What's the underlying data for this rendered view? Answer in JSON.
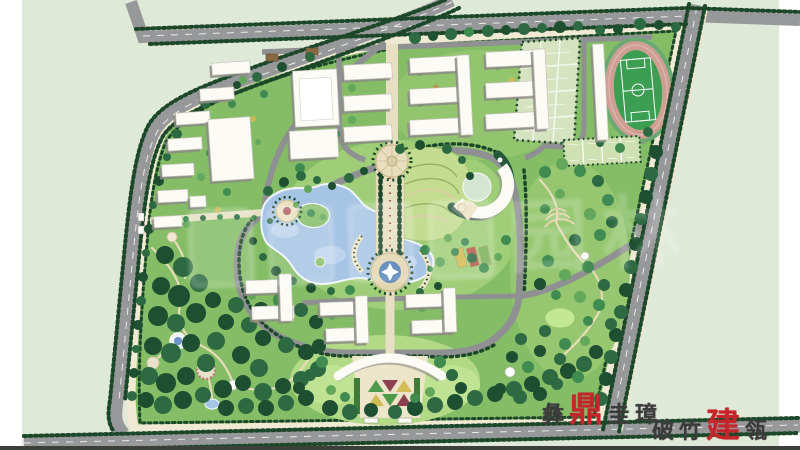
{
  "canvas": {
    "width": 800,
    "height": 450
  },
  "watermarks": {
    "center_glyphs": [
      "园",
      "林"
    ],
    "seal_line1": [
      "彝",
      "鼎",
      "圭",
      "璋"
    ],
    "seal_line2": [
      "破",
      "竹",
      "建",
      "瓴"
    ],
    "seal_red_chars": [
      "鼎",
      "建"
    ]
  },
  "palette": {
    "outer_bg": "#dfe9d8",
    "campus_green": "#85bd66",
    "lawn_light": "#a9d37e",
    "lawn_bright": "#bfe392",
    "sidewalk_cream": "#f0e9d4",
    "road_gray": "#97989a",
    "inner_road_gray": "#8f9092",
    "hedge_dark": "#1c4729",
    "lake_blue": "#a6c4e4",
    "lake_highlight": "#c6daf1",
    "track_pink": "#cf9f94",
    "field_green": "#3b9e52",
    "court_fill": "#d6e3c0",
    "building_white": "#fcfbf6",
    "building_shadow": "#8b8b85",
    "axis_cream": "#e7dfc2",
    "seal_red": "#c5262b",
    "seal_black": "#3b3b3b",
    "parterre_green": "#4e9a4a",
    "parterre_maroon": "#8d4050",
    "parterre_yellow": "#d2bc55"
  },
  "tree_colors": [
    "#1d4f30",
    "#2d6a42",
    "#3f8b50",
    "#63a75a",
    "#8cc06a",
    "#c9ba55",
    "#bf8c4a"
  ],
  "buildings": [
    [
      212,
      62,
      38,
      12,
      -4
    ],
    [
      200,
      88,
      34,
      12,
      -4
    ],
    [
      176,
      112,
      34,
      12,
      -4
    ],
    [
      168,
      138,
      34,
      12,
      -4
    ],
    [
      162,
      164,
      32,
      12,
      -3
    ],
    [
      158,
      190,
      30,
      12,
      -3
    ],
    [
      190,
      196,
      16,
      11,
      -3
    ],
    [
      154,
      216,
      28,
      11,
      -3
    ],
    [
      210,
      118,
      42,
      62,
      -4
    ],
    [
      294,
      70,
      44,
      56,
      -3
    ],
    [
      290,
      130,
      48,
      28,
      -3
    ],
    [
      344,
      64,
      48,
      15,
      -3
    ],
    [
      344,
      95,
      48,
      15,
      -3
    ],
    [
      344,
      126,
      48,
      15,
      -3
    ],
    [
      410,
      57,
      50,
      15,
      -3
    ],
    [
      410,
      88,
      50,
      15,
      -3
    ],
    [
      410,
      119,
      50,
      15,
      -3
    ],
    [
      459,
      55,
      12,
      80,
      -3
    ],
    [
      486,
      51,
      50,
      15,
      -3
    ],
    [
      486,
      82,
      50,
      15,
      -3
    ],
    [
      486,
      113,
      50,
      15,
      -3
    ],
    [
      535,
      49,
      12,
      80,
      -3
    ],
    [
      246,
      280,
      40,
      13,
      -2
    ],
    [
      252,
      306,
      42,
      13,
      -2
    ],
    [
      280,
      274,
      12,
      47,
      -2
    ],
    [
      320,
      302,
      40,
      13,
      -2
    ],
    [
      326,
      328,
      42,
      13,
      -2
    ],
    [
      356,
      296,
      12,
      47,
      -2
    ],
    [
      406,
      294,
      40,
      13,
      -2
    ],
    [
      412,
      320,
      42,
      13,
      -2
    ],
    [
      444,
      288,
      12,
      44,
      -2
    ],
    [
      595,
      44,
      11,
      96,
      -3
    ]
  ],
  "trees": [
    [
      415,
      38,
      6,
      1
    ],
    [
      433,
      36,
      5,
      0
    ],
    [
      451,
      34,
      6,
      1
    ],
    [
      469,
      32,
      5,
      2
    ],
    [
      488,
      31,
      6,
      1
    ],
    [
      506,
      30,
      5,
      0
    ],
    [
      524,
      29,
      6,
      1
    ],
    [
      542,
      28,
      5,
      1
    ],
    [
      560,
      27,
      6,
      0
    ],
    [
      578,
      26,
      5,
      1
    ],
    [
      640,
      24,
      6,
      1
    ],
    [
      659,
      25,
      5,
      0
    ],
    [
      676,
      27,
      5,
      1
    ],
    [
      310,
      57,
      5,
      1
    ],
    [
      282,
      67,
      5,
      0
    ],
    [
      257,
      77,
      5,
      1
    ],
    [
      237,
      85,
      4,
      0
    ],
    [
      222,
      93,
      4,
      1
    ],
    [
      205,
      103,
      5,
      1
    ],
    [
      190,
      117,
      4,
      0
    ],
    [
      177,
      134,
      5,
      1
    ],
    [
      167,
      157,
      4,
      1
    ],
    [
      159,
      181,
      5,
      0
    ],
    [
      153,
      205,
      4,
      1
    ],
    [
      149,
      229,
      5,
      0
    ],
    [
      146,
      253,
      4,
      1
    ],
    [
      143,
      277,
      5,
      0
    ],
    [
      141,
      301,
      5,
      1
    ],
    [
      138,
      325,
      5,
      0
    ],
    [
      136,
      349,
      4,
      1
    ],
    [
      134,
      373,
      5,
      0
    ],
    [
      132,
      396,
      5,
      1
    ],
    [
      243,
      80,
      4,
      3
    ],
    [
      232,
      104,
      4,
      2
    ],
    [
      220,
      129,
      4,
      3
    ],
    [
      210,
      153,
      4,
      2
    ],
    [
      201,
      177,
      4,
      3
    ],
    [
      193,
      201,
      4,
      2
    ],
    [
      187,
      224,
      4,
      3
    ],
    [
      264,
      94,
      4,
      2
    ],
    [
      253,
      119,
      3,
      5
    ],
    [
      243,
      143,
      4,
      2
    ],
    [
      234,
      168,
      3,
      6
    ],
    [
      227,
      192,
      4,
      2
    ],
    [
      258,
      142,
      3,
      3
    ],
    [
      218,
      210,
      3,
      5
    ],
    [
      300,
      168,
      5,
      2
    ],
    [
      318,
      150,
      5,
      3
    ],
    [
      336,
      134,
      4,
      2
    ],
    [
      308,
      189,
      4,
      3
    ],
    [
      283,
      184,
      4,
      2
    ],
    [
      296,
      205,
      3,
      3
    ],
    [
      270,
      221,
      3,
      1
    ],
    [
      254,
      218,
      3,
      2
    ],
    [
      237,
      217,
      3,
      1
    ],
    [
      220,
      217,
      3,
      2
    ],
    [
      203,
      218,
      3,
      1
    ],
    [
      186,
      219,
      3,
      2
    ],
    [
      170,
      220,
      3,
      1
    ],
    [
      268,
      191,
      5,
      1
    ],
    [
      284,
      182,
      5,
      0
    ],
    [
      301,
      176,
      5,
      1
    ],
    [
      317,
      180,
      4,
      1
    ],
    [
      332,
      186,
      4,
      0
    ],
    [
      349,
      178,
      5,
      1
    ],
    [
      364,
      171,
      4,
      0
    ],
    [
      311,
      213,
      4,
      2
    ],
    [
      323,
      217,
      3,
      3
    ],
    [
      400,
      149,
      5,
      1
    ],
    [
      420,
      145,
      5,
      0
    ],
    [
      447,
      149,
      5,
      1
    ],
    [
      462,
      160,
      4,
      1
    ],
    [
      470,
      176,
      4,
      0
    ],
    [
      350,
      290,
      5,
      2
    ],
    [
      331,
      291,
      4,
      1
    ],
    [
      311,
      288,
      5,
      0
    ],
    [
      293,
      281,
      4,
      1
    ],
    [
      276,
      271,
      5,
      0
    ],
    [
      263,
      257,
      4,
      1
    ],
    [
      253,
      241,
      4,
      0
    ],
    [
      420,
      292,
      4,
      1
    ],
    [
      438,
      286,
      4,
      0
    ],
    [
      430,
      269,
      3,
      2
    ],
    [
      165,
      255,
      9,
      0
    ],
    [
      183,
      267,
      10,
      1
    ],
    [
      161,
      286,
      9,
      0
    ],
    [
      179,
      296,
      11,
      0
    ],
    [
      199,
      283,
      9,
      1
    ],
    [
      158,
      316,
      10,
      0
    ],
    [
      176,
      323,
      9,
      1
    ],
    [
      196,
      313,
      10,
      0
    ],
    [
      153,
      346,
      9,
      0
    ],
    [
      171,
      353,
      10,
      1
    ],
    [
      191,
      343,
      9,
      0
    ],
    [
      149,
      376,
      9,
      1
    ],
    [
      166,
      383,
      10,
      0
    ],
    [
      186,
      376,
      9,
      0
    ],
    [
      206,
      363,
      9,
      1
    ],
    [
      146,
      400,
      8,
      0
    ],
    [
      163,
      405,
      9,
      1
    ],
    [
      183,
      400,
      9,
      0
    ],
    [
      203,
      395,
      8,
      1
    ],
    [
      223,
      389,
      9,
      0
    ],
    [
      216,
      341,
      9,
      1
    ],
    [
      226,
      322,
      8,
      0
    ],
    [
      236,
      305,
      8,
      1
    ],
    [
      213,
      300,
      8,
      0
    ],
    [
      241,
      355,
      9,
      0
    ],
    [
      259,
      368,
      9,
      1
    ],
    [
      243,
      383,
      8,
      0
    ],
    [
      263,
      392,
      9,
      1
    ],
    [
      283,
      386,
      8,
      0
    ],
    [
      301,
      379,
      8,
      1
    ],
    [
      226,
      408,
      8,
      0
    ],
    [
      246,
      406,
      8,
      1
    ],
    [
      266,
      408,
      8,
      0
    ],
    [
      286,
      403,
      8,
      1
    ],
    [
      306,
      398,
      8,
      0
    ],
    [
      318,
      369,
      8,
      1
    ],
    [
      306,
      352,
      8,
      0
    ],
    [
      286,
      345,
      8,
      1
    ],
    [
      263,
      338,
      8,
      0
    ],
    [
      249,
      325,
      8,
      1
    ],
    [
      261,
      310,
      8,
      0
    ],
    [
      281,
      300,
      8,
      2
    ],
    [
      301,
      310,
      7,
      1
    ],
    [
      316,
      322,
      7,
      0
    ],
    [
      331,
      335,
      7,
      1
    ],
    [
      319,
      346,
      7,
      0
    ],
    [
      330,
      408,
      8,
      0
    ],
    [
      350,
      412,
      8,
      1
    ],
    [
      371,
      410,
      7,
      0
    ],
    [
      395,
      412,
      7,
      1
    ],
    [
      415,
      408,
      8,
      0
    ],
    [
      435,
      405,
      8,
      1
    ],
    [
      455,
      402,
      8,
      0
    ],
    [
      475,
      398,
      8,
      1
    ],
    [
      495,
      394,
      8,
      0
    ],
    [
      514,
      389,
      8,
      1
    ],
    [
      532,
      384,
      8,
      0
    ],
    [
      550,
      377,
      8,
      1
    ],
    [
      568,
      371,
      8,
      0
    ],
    [
      584,
      364,
      8,
      1
    ],
    [
      596,
      352,
      7,
      0
    ],
    [
      656,
      152,
      7,
      0
    ],
    [
      651,
      174,
      7,
      1
    ],
    [
      646,
      197,
      7,
      0
    ],
    [
      641,
      219,
      6,
      1
    ],
    [
      636,
      244,
      7,
      0
    ],
    [
      631,
      267,
      7,
      1
    ],
    [
      626,
      290,
      7,
      0
    ],
    [
      621,
      312,
      7,
      1
    ],
    [
      616,
      335,
      7,
      0
    ],
    [
      611,
      357,
      7,
      1
    ],
    [
      606,
      379,
      7,
      0
    ],
    [
      601,
      399,
      7,
      1
    ],
    [
      545,
      172,
      6,
      2
    ],
    [
      562,
      164,
      6,
      3
    ],
    [
      580,
      171,
      6,
      2
    ],
    [
      598,
      181,
      6,
      1
    ],
    [
      608,
      200,
      6,
      2
    ],
    [
      612,
      222,
      6,
      1
    ],
    [
      560,
      194,
      5,
      3
    ],
    [
      545,
      209,
      5,
      2
    ],
    [
      590,
      214,
      6,
      3
    ],
    [
      600,
      235,
      6,
      2
    ],
    [
      575,
      240,
      6,
      1
    ],
    [
      548,
      261,
      6,
      2
    ],
    [
      565,
      275,
      6,
      3
    ],
    [
      588,
      267,
      6,
      2
    ],
    [
      604,
      285,
      6,
      1
    ],
    [
      540,
      284,
      6,
      0
    ],
    [
      556,
      295,
      5,
      2
    ],
    [
      580,
      297,
      6,
      3
    ],
    [
      599,
      305,
      6,
      2
    ],
    [
      611,
      324,
      6,
      1
    ],
    [
      588,
      321,
      5,
      2
    ],
    [
      545,
      331,
      6,
      1
    ],
    [
      565,
      344,
      6,
      2
    ],
    [
      585,
      341,
      5,
      3
    ],
    [
      560,
      359,
      6,
      1
    ],
    [
      540,
      351,
      6,
      0
    ],
    [
      578,
      377,
      6,
      2
    ],
    [
      557,
      384,
      6,
      1
    ],
    [
      521,
      339,
      6,
      1
    ],
    [
      512,
      357,
      6,
      0
    ],
    [
      528,
      367,
      6,
      2
    ],
    [
      540,
      394,
      7,
      0
    ],
    [
      520,
      397,
      7,
      1
    ],
    [
      500,
      389,
      6,
      0
    ],
    [
      322,
      362,
      6,
      2
    ],
    [
      310,
      375,
      6,
      1
    ],
    [
      299,
      388,
      6,
      0
    ],
    [
      331,
      390,
      5,
      3
    ],
    [
      345,
      397,
      5,
      2
    ],
    [
      440,
      362,
      6,
      2
    ],
    [
      452,
      375,
      6,
      1
    ],
    [
      461,
      388,
      6,
      0
    ],
    [
      430,
      392,
      5,
      3
    ],
    [
      415,
      398,
      5,
      2
    ],
    [
      352,
      88,
      4,
      3
    ],
    [
      352,
      120,
      4,
      3
    ],
    [
      367,
      76,
      3,
      5
    ],
    [
      420,
      72,
      4,
      3
    ],
    [
      420,
      103,
      4,
      3
    ],
    [
      436,
      88,
      3,
      6
    ],
    [
      498,
      66,
      4,
      3
    ],
    [
      498,
      97,
      4,
      3
    ],
    [
      512,
      80,
      3,
      5
    ],
    [
      415,
      134,
      3,
      3
    ],
    [
      492,
      128,
      3,
      3
    ],
    [
      252,
      296,
      4,
      3
    ],
    [
      256,
      320,
      3,
      6
    ],
    [
      332,
      316,
      4,
      3
    ],
    [
      336,
      340,
      3,
      5
    ],
    [
      422,
      308,
      4,
      3
    ],
    [
      426,
      332,
      3,
      6
    ],
    [
      530,
      60,
      5,
      2
    ],
    [
      528,
      90,
      5,
      1
    ],
    [
      526,
      120,
      4,
      2
    ],
    [
      600,
      30,
      5,
      1
    ],
    [
      618,
      29,
      5,
      0
    ],
    [
      620,
      148,
      5,
      2
    ],
    [
      600,
      143,
      4,
      1
    ],
    [
      648,
      132,
      5,
      1
    ],
    [
      425,
      250,
      5,
      2
    ],
    [
      440,
      262,
      5,
      3
    ],
    [
      455,
      252,
      4,
      2
    ],
    [
      448,
      238,
      4,
      3
    ],
    [
      465,
      242,
      4,
      2
    ],
    [
      472,
      258,
      5,
      1
    ],
    [
      484,
      268,
      5,
      2
    ],
    [
      498,
      257,
      4,
      3
    ],
    [
      506,
      240,
      5,
      2
    ]
  ]
}
